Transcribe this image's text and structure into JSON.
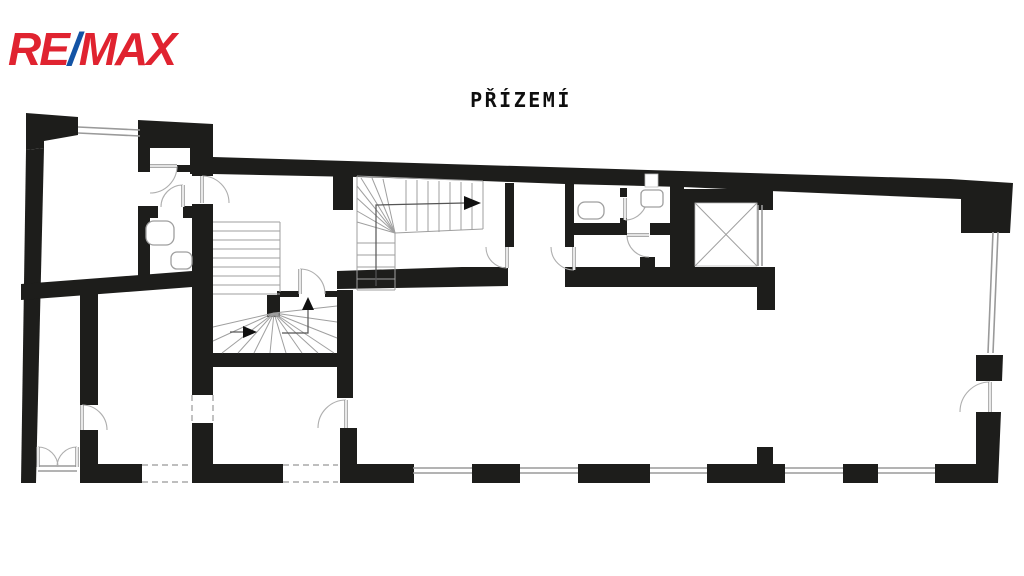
{
  "logo": {
    "re": "RE",
    "slash": "/",
    "max": "MAX",
    "red": "#E02330",
    "blue": "#1353A5"
  },
  "title": {
    "text": "PŘÍZEMÍ"
  },
  "floorplan": {
    "colors": {
      "wall": "#1d1d1b",
      "window": "#9a9a9a",
      "stair": "#9f9f9f",
      "door_arc": "#aeaeae",
      "door_leaf": "#8f8f8f",
      "dash": "#a9a9a9",
      "walk": "#555555",
      "arrow": "#111111",
      "fixture": "#9f9f9f"
    },
    "walls_poly": [
      [
        [
          26,
          113
        ],
        [
          78,
          117
        ],
        [
          78,
          135
        ],
        [
          44,
          141
        ],
        [
          44,
          148
        ],
        [
          26,
          150
        ]
      ],
      [
        [
          26,
          150
        ],
        [
          44,
          148
        ],
        [
          36,
          483
        ],
        [
          21,
          483
        ]
      ],
      [
        [
          138,
          120
        ],
        [
          213,
          124
        ],
        [
          213,
          174
        ],
        [
          190,
          174
        ],
        [
          190,
          148
        ],
        [
          138,
          148
        ]
      ],
      [
        [
          213,
          157
        ],
        [
          950,
          179
        ],
        [
          1013,
          183
        ],
        [
          1010,
          233
        ],
        [
          961,
          233
        ],
        [
          961,
          199
        ],
        [
          770,
          191
        ],
        [
          683,
          187
        ],
        [
          565,
          184
        ],
        [
          483,
          181
        ],
        [
          357,
          177
        ],
        [
          213,
          174
        ]
      ],
      [
        [
          21,
          284
        ],
        [
          192,
          271
        ],
        [
          192,
          287
        ],
        [
          21,
          300
        ]
      ],
      [
        [
          337,
          271
        ],
        [
          462,
          267
        ],
        [
          508,
          267
        ],
        [
          508,
          286
        ],
        [
          337,
          289
        ]
      ],
      [
        [
          976,
          412
        ],
        [
          1001,
          412
        ],
        [
          998,
          483
        ],
        [
          935,
          483
        ],
        [
          935,
          464
        ],
        [
          976,
          464
        ]
      ],
      [
        [
          976,
          355
        ],
        [
          1003,
          355
        ],
        [
          1002,
          381
        ],
        [
          976,
          381
        ]
      ]
    ],
    "walls_rect": [
      [
        333,
        176,
        20,
        34
      ],
      [
        138,
        148,
        12,
        24
      ],
      [
        138,
        206,
        12,
        80
      ],
      [
        140,
        206,
        18,
        12
      ],
      [
        183,
        206,
        29,
        12
      ],
      [
        177,
        165,
        15,
        7
      ],
      [
        192,
        148,
        21,
        28
      ],
      [
        192,
        204,
        21,
        191
      ],
      [
        192,
        423,
        21,
        42
      ],
      [
        80,
        280,
        18,
        125
      ],
      [
        80,
        430,
        18,
        36
      ],
      [
        213,
        353,
        140,
        14
      ],
      [
        337,
        290,
        16,
        108
      ],
      [
        340,
        428,
        17,
        55
      ],
      [
        340,
        464,
        74,
        19
      ],
      [
        565,
        267,
        210,
        20
      ],
      [
        640,
        257,
        15,
        11
      ],
      [
        757,
        287,
        18,
        23
      ],
      [
        565,
        182,
        9,
        65
      ],
      [
        505,
        183,
        9,
        64
      ],
      [
        620,
        188,
        7,
        9
      ],
      [
        620,
        218,
        7,
        6
      ],
      [
        565,
        223,
        62,
        12
      ],
      [
        650,
        223,
        20,
        12
      ],
      [
        670,
        186,
        14,
        82
      ],
      [
        683,
        189,
        90,
        14
      ],
      [
        683,
        203,
        12,
        65
      ],
      [
        757,
        189,
        16,
        21
      ],
      [
        277,
        291,
        22,
        6
      ],
      [
        325,
        291,
        12,
        6
      ],
      [
        267,
        295,
        13,
        22
      ],
      [
        80,
        464,
        62,
        19
      ],
      [
        192,
        464,
        91,
        19
      ],
      [
        472,
        464,
        48,
        19
      ],
      [
        578,
        464,
        72,
        19
      ],
      [
        707,
        464,
        78,
        19
      ],
      [
        757,
        447,
        16,
        17
      ],
      [
        843,
        464,
        35,
        19
      ]
    ],
    "white_rects": [
      [
        695,
        203,
        62,
        63
      ],
      [
        645,
        174,
        13,
        13
      ]
    ],
    "window_pairs": [
      [
        78,
        127,
        140,
        130,
        0,
        6
      ],
      [
        993,
        232,
        988,
        353,
        5,
        0
      ],
      [
        413,
        468,
        472,
        468,
        0,
        5
      ],
      [
        520,
        468,
        578,
        468,
        0,
        5
      ],
      [
        650,
        468,
        707,
        468,
        0,
        5
      ],
      [
        785,
        468,
        843,
        468,
        0,
        5
      ],
      [
        878,
        468,
        935,
        468,
        0,
        5
      ],
      [
        758,
        205,
        758,
        266,
        4,
        0
      ],
      [
        38,
        466,
        77,
        466,
        0,
        5
      ]
    ],
    "dashed_rects": [
      [
        142,
        465,
        50,
        17
      ],
      [
        283,
        465,
        55,
        17
      ],
      [
        192,
        395,
        21,
        28
      ]
    ],
    "doors": [
      {
        "leaf": [
          150,
          166,
          177,
          166
        ],
        "arc": [
          177,
          166,
          27,
          150,
          193,
          1
        ]
      },
      {
        "leaf": [
          202,
          176,
          202,
          203
        ],
        "arc": [
          202,
          176,
          27,
          229,
          203,
          1
        ]
      },
      {
        "leaf": [
          183,
          185,
          183,
          207
        ],
        "arc": [
          183,
          185,
          22,
          161,
          207,
          0
        ]
      },
      {
        "leaf": [
          507,
          247,
          507,
          268
        ],
        "arc": [
          507,
          268,
          21,
          486,
          247,
          1
        ]
      },
      {
        "leaf": [
          574,
          247,
          574,
          270
        ],
        "arc": [
          574,
          270,
          23,
          551,
          247,
          1
        ]
      },
      {
        "leaf": [
          625,
          198,
          625,
          220
        ],
        "arc": [
          625,
          220,
          22,
          647,
          198,
          0
        ]
      },
      {
        "leaf": [
          627,
          235,
          649,
          235
        ],
        "arc": [
          627,
          235,
          22,
          649,
          257,
          0
        ]
      },
      {
        "leaf": [
          300,
          269,
          300,
          294
        ],
        "arc": [
          300,
          269,
          25,
          325,
          294,
          1
        ]
      },
      {
        "leaf": [
          82,
          405,
          82,
          430
        ],
        "arc": [
          82,
          405,
          25,
          107,
          430,
          1
        ]
      },
      {
        "leaf": [
          346,
          400,
          346,
          428
        ],
        "arc": [
          346,
          400,
          28,
          318,
          428,
          0
        ]
      },
      {
        "leaf": [
          990,
          382,
          990,
          412
        ],
        "arc": [
          990,
          382,
          30,
          960,
          412,
          0
        ]
      },
      {
        "leaf": [
          38,
          447,
          38,
          467
        ],
        "arc": [
          38,
          447,
          20,
          58,
          467,
          1
        ]
      },
      {
        "leaf": [
          77,
          447,
          77,
          467
        ],
        "arc": [
          77,
          447,
          20,
          57,
          467,
          0
        ]
      }
    ],
    "stair_lines": [
      [
        213,
        222,
        280,
        222
      ],
      [
        213,
        231,
        280,
        231
      ],
      [
        213,
        240,
        280,
        240
      ],
      [
        213,
        249,
        280,
        249
      ],
      [
        213,
        258,
        280,
        258
      ],
      [
        213,
        267,
        280,
        267
      ],
      [
        213,
        276,
        280,
        276
      ],
      [
        213,
        285,
        280,
        285
      ],
      [
        213,
        294,
        280,
        294
      ],
      [
        280,
        222,
        280,
        292
      ],
      [
        274,
        313,
        213,
        327
      ],
      [
        274,
        313,
        213,
        341
      ],
      [
        274,
        313,
        222,
        353
      ],
      [
        274,
        313,
        238,
        353
      ],
      [
        274,
        313,
        254,
        353
      ],
      [
        274,
        313,
        270,
        353
      ],
      [
        274,
        313,
        286,
        353
      ],
      [
        274,
        313,
        302,
        353
      ],
      [
        274,
        313,
        318,
        353
      ],
      [
        274,
        313,
        334,
        353
      ],
      [
        274,
        313,
        337,
        338
      ],
      [
        274,
        313,
        337,
        322
      ],
      [
        274,
        313,
        337,
        306
      ],
      [
        357,
        176,
        483,
        181
      ],
      [
        483,
        181,
        483,
        229
      ],
      [
        483,
        229,
        395,
        233
      ],
      [
        395,
        233,
        395,
        290
      ],
      [
        395,
        290,
        357,
        290
      ],
      [
        357,
        290,
        357,
        176
      ],
      [
        406,
        180,
        406,
        231
      ],
      [
        417,
        180,
        417,
        231
      ],
      [
        428,
        181,
        428,
        232
      ],
      [
        439,
        181,
        439,
        232
      ],
      [
        450,
        182,
        450,
        230
      ],
      [
        461,
        182,
        461,
        230
      ],
      [
        472,
        183,
        472,
        230
      ],
      [
        395,
        233,
        357,
        186
      ],
      [
        395,
        233,
        357,
        198
      ],
      [
        395,
        233,
        357,
        211
      ],
      [
        395,
        233,
        357,
        222
      ],
      [
        395,
        233,
        361,
        178
      ],
      [
        395,
        233,
        372,
        178
      ],
      [
        395,
        233,
        383,
        179
      ],
      [
        357,
        243,
        395,
        243
      ],
      [
        357,
        255,
        395,
        255
      ],
      [
        357,
        267,
        395,
        267
      ],
      [
        357,
        279,
        395,
        279
      ],
      [
        695,
        203,
        757,
        266
      ],
      [
        695,
        266,
        757,
        203
      ]
    ],
    "walk_lines": [
      [
        [
          376,
          286
        ],
        [
          376,
          205
        ],
        [
          464,
          203
        ]
      ],
      [
        [
          230,
          332
        ],
        [
          243,
          332
        ]
      ],
      [
        [
          282,
          333
        ],
        [
          308,
          333
        ],
        [
          308,
          310
        ]
      ]
    ],
    "arrows": [
      [
        464,
        196,
        481,
        203,
        464,
        210
      ],
      [
        243,
        326,
        257,
        332,
        243,
        338
      ],
      [
        302,
        310,
        308,
        297,
        314,
        310
      ]
    ],
    "fixtures": [
      [
        146,
        221,
        28,
        24,
        8
      ],
      [
        171,
        252,
        21,
        17,
        6
      ],
      [
        578,
        202,
        26,
        17,
        7
      ],
      [
        641,
        190,
        22,
        17,
        4
      ]
    ]
  }
}
